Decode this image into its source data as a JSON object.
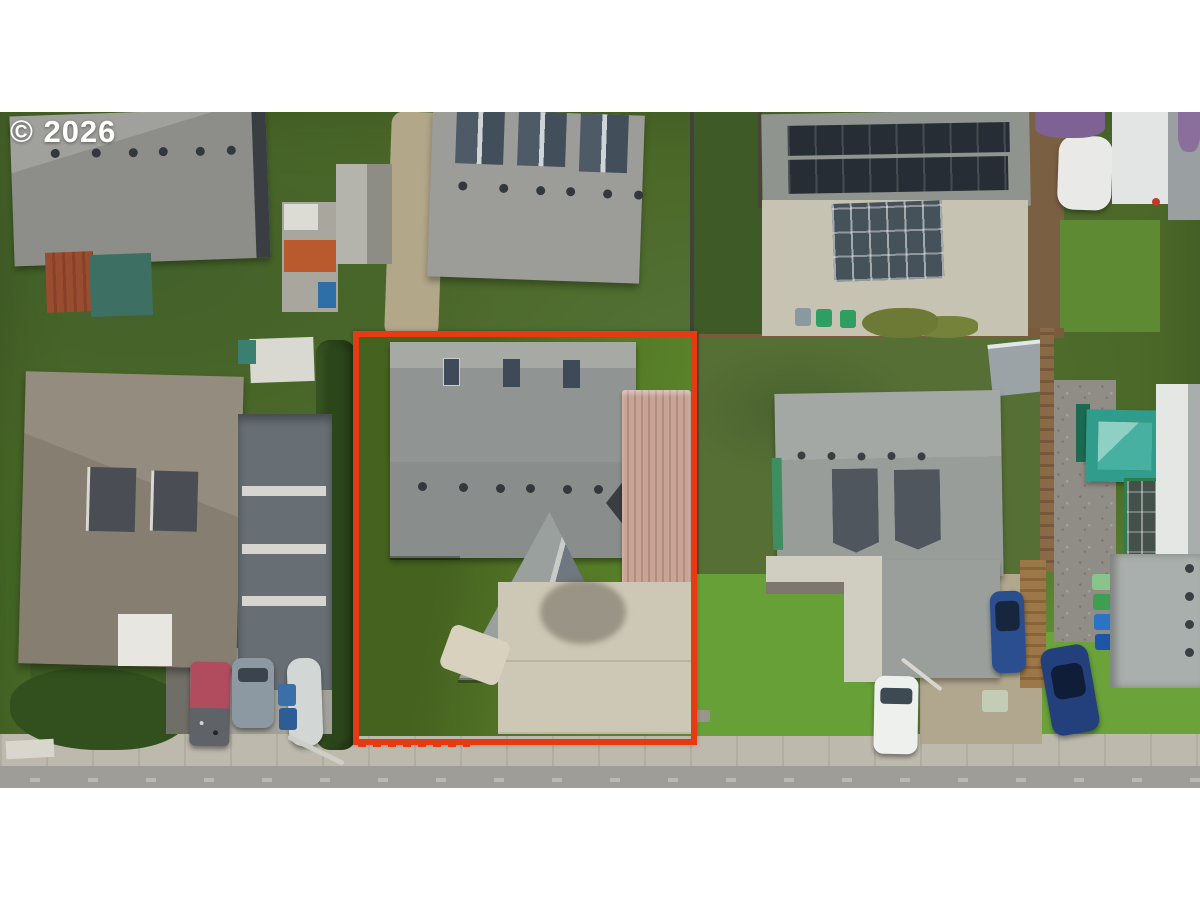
{
  "watermark": {
    "text": "© 2026"
  },
  "photo": {
    "description": "Aerial drone view of a residential neighborhood; the subject lot is outlined in red and contains a gray-roofed house, a tan corrugated metal carport and a concrete driveway, with lawn, a trimmed hedge on the west side, a sidewalk and street along the bottom, and neighboring houses (one with rooftop solar panels) all around",
    "boundary_style": "solid red-orange outline with short dashed ticks along the street frontage"
  },
  "colors": {
    "boundary": "#e83a12",
    "grass_bright": "#68a038",
    "grass_mid": "#53732f",
    "grass_dark": "#3e5a27",
    "hedge": "#2c461b",
    "roof_light": "#9c9c98",
    "roof_mid": "#8f9290",
    "roof_dark": "#4e5a66",
    "carport": "#c5a094",
    "concrete": "#c7c3b3",
    "driveway": "#cdc7b6",
    "sidewalk": "#bdbaad",
    "street": "#9e9d97",
    "solar_panel": "#272d34",
    "soil": "#7b5f42",
    "wood_fence": "#8a6a46",
    "shed_rust": "#9a4c30",
    "teal_structure": "#2f9c8c",
    "white_structure": "#e7e9e6",
    "car_red": "#b14b5e",
    "car_gray": "#8d99a2",
    "car_white": "#eef0ee",
    "car_blue": "#2b4f8e",
    "car_dark_blue": "#24407c",
    "bin_blue": "#3a6fa8",
    "bin_green": "#3f9e4f"
  }
}
